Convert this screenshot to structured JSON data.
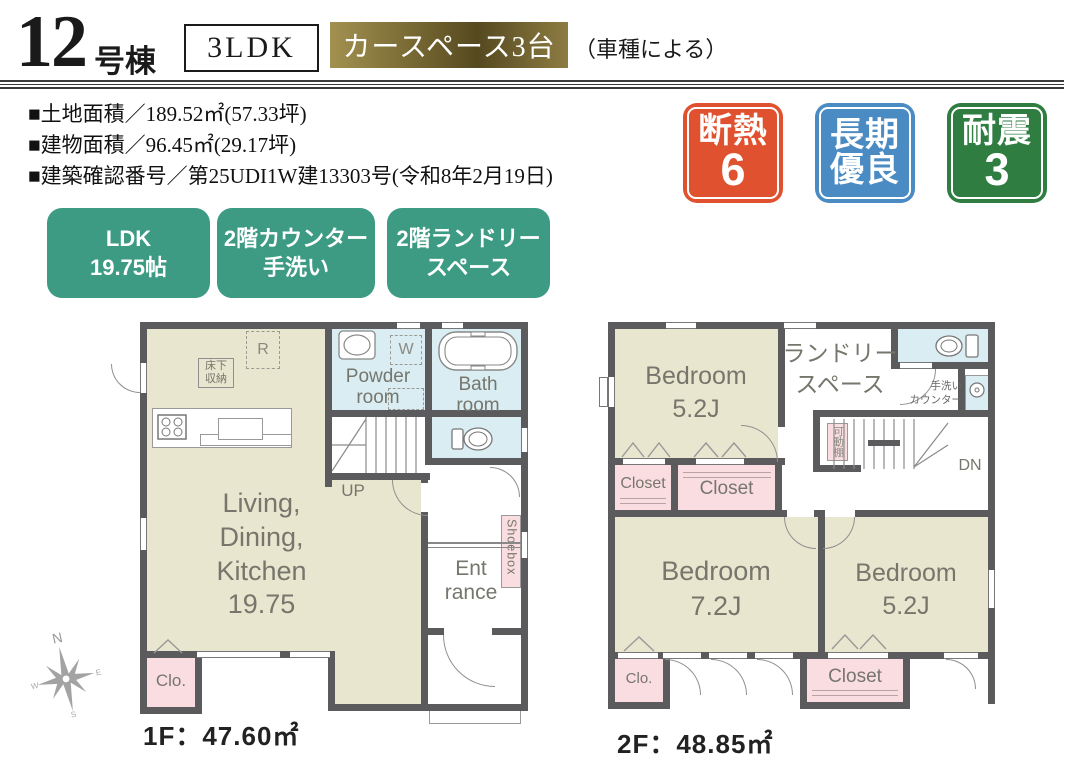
{
  "header": {
    "unit_number": "12",
    "unit_label": "号棟",
    "plan_type": "3LDK",
    "car_space": "カースペース3台",
    "car_space_note": "（車種による）"
  },
  "info": {
    "land_area": "■土地面積／189.52㎡(57.33坪)",
    "building_area": "■建物面積／96.45㎡(29.17坪)",
    "confirmation": "■建築確認番号／第25UDI1W建13303号(令和8年2月19日)"
  },
  "badges": {
    "items": [
      {
        "line1": "断熱",
        "line2": "6",
        "color": "#e0512f"
      },
      {
        "line1": "長期",
        "line2": "優良",
        "color": "#4a8bc3"
      },
      {
        "line1": "耐震",
        "line2": "3",
        "color": "#2f7d41"
      }
    ]
  },
  "features": {
    "color": "#3d9b84",
    "items": [
      {
        "text": "LDK\n19.75帖"
      },
      {
        "text": "2階カウンター\n手洗い"
      },
      {
        "text": "2階ランドリー\nスペース"
      }
    ]
  },
  "floor1": {
    "caption": "1F：47.60㎡",
    "ldk": "Living,\nDining,\nKitchen\n19.75",
    "powder": "Powder\nroom",
    "bath": "Bath\nroom",
    "up": "UP",
    "underfloor": "床下\n収納",
    "fridge": "R",
    "washer": "W",
    "entrance": "Ent\nrance",
    "shoebox": "Shoebox",
    "closet": "Clo."
  },
  "floor2": {
    "caption": "2F：48.85㎡",
    "bedroom_a": "Bedroom\n5.2J",
    "bedroom_b": "Bedroom\n7.2J",
    "bedroom_c": "Bedroom\n5.2J",
    "laundry": "ランドリー\nスペース",
    "handwash": "手洗い\nカウンター",
    "shelf": "可動棚",
    "down": "DN",
    "closet_a": "Closet",
    "closet_b": "Closet",
    "closet_c": "Closet",
    "clo": "Clo."
  },
  "compass": {
    "n": "N",
    "e": "E",
    "s": "S",
    "w": "W"
  },
  "colors": {
    "wall": "#5b5b5e",
    "room_beige": "#e9e6cf",
    "room_blue": "#d9edf3",
    "room_pink": "#fadde0",
    "accent_teal": "#3d9b84",
    "gold_light": "#a29150",
    "gold_dark": "#554920",
    "label_gray": "#76766c"
  }
}
